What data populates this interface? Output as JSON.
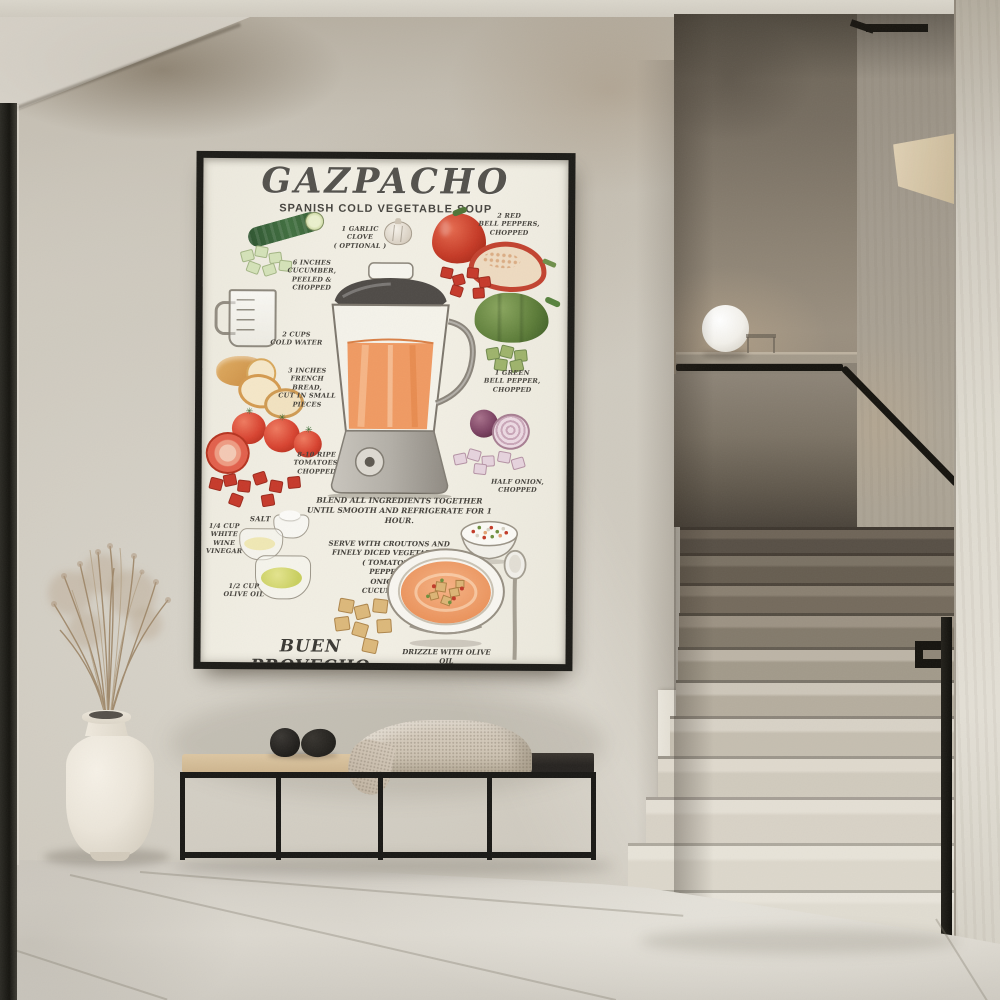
{
  "scene": {
    "objects": [
      "framed-recipe-poster",
      "bench",
      "throw-blanket",
      "decor-stones",
      "vase-with-dried-grass",
      "sphere-lamp",
      "staircase",
      "black-handrail",
      "tiled-floor"
    ]
  },
  "poster": {
    "title": "GAZPACHO",
    "subtitle": "SPANISH COLD VEGETABLE SOUP",
    "ingredients": [
      {
        "id": "cucumber",
        "lines": [
          "6 INCHES",
          "CUCUMBER,",
          "PEELED &",
          "CHOPPED"
        ]
      },
      {
        "id": "garlic",
        "lines": [
          "1 GARLIC CLOVE",
          "( OPTIONAL )"
        ]
      },
      {
        "id": "red-peppers",
        "lines": [
          "2 RED",
          "BELL PEPPERS,",
          "CHOPPED"
        ]
      },
      {
        "id": "water",
        "lines": [
          "2 CUPS",
          "COLD WATER"
        ]
      },
      {
        "id": "green-pepper",
        "lines": [
          "1 GREEN",
          "BELL PEPPER,",
          "CHOPPED"
        ]
      },
      {
        "id": "bread",
        "lines": [
          "3 INCHES",
          "FRENCH",
          "BREAD,",
          "CUT IN SMALL PIECES"
        ]
      },
      {
        "id": "tomatoes",
        "lines": [
          "8-10 RIPE",
          "TOMATOES,",
          "CHOPPED"
        ]
      },
      {
        "id": "onion",
        "lines": [
          "HALF ONION,",
          "CHOPPED"
        ]
      },
      {
        "id": "salt",
        "lines": [
          "SALT"
        ]
      },
      {
        "id": "vinegar",
        "lines": [
          "1/4 CUP",
          "WHITE",
          "WINE",
          "VINEGAR"
        ]
      },
      {
        "id": "olive-oil",
        "lines": [
          "1/2 CUP",
          "OLIVE OIL"
        ]
      }
    ],
    "instructions": {
      "blend": [
        "BLEND ALL INGREDIENTS TOGETHER",
        "UNTIL SMOOTH AND REFRIGERATE FOR 1 HOUR."
      ],
      "serve": [
        "SERVE WITH CROUTONS AND",
        "FINELY DICED VEGETABLES",
        "( TOMATOES,",
        "PEPPERS,",
        "ONION &",
        "CUCUMBER )"
      ]
    },
    "footer": {
      "phrase": "BUEN PROVECHO",
      "note": "DRIZZLE WITH OLIVE OIL"
    }
  },
  "colors": {
    "poster_bg": "#f0ede2",
    "frame": "#1c1b17",
    "wall": "#cbc6bb",
    "soup_orange": "#f0a173",
    "pepper_red": "#c63a26",
    "pepper_green": "#5c7c38",
    "onion_purple": "#7c4262",
    "step_light": "#e7e2d7",
    "step_dark": "#5f574c",
    "rail": "#15130e",
    "cushion": "#d5bd97",
    "blanket": "#cfc5b4"
  }
}
